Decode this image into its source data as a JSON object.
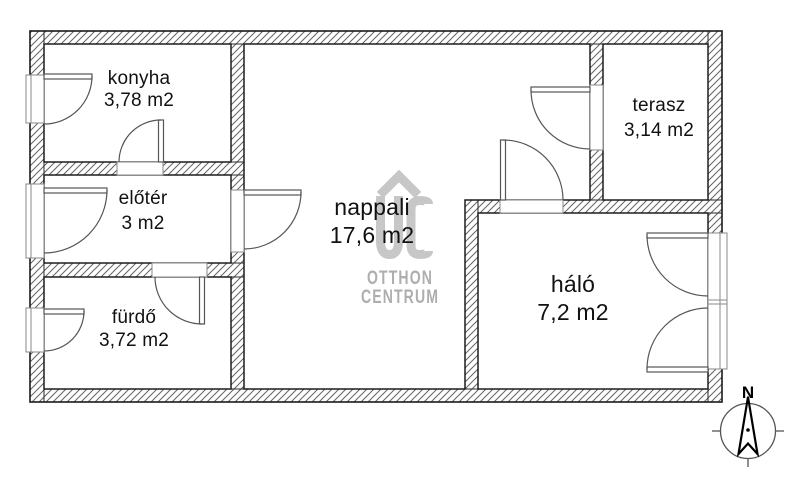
{
  "rooms": [
    {
      "name": "konyha",
      "area": "3,78 m2"
    },
    {
      "name": "előtér",
      "area": "3 m2"
    },
    {
      "name": "fürdő",
      "area": "3,72 m2"
    },
    {
      "name": "nappali",
      "area": "17,6 m2"
    },
    {
      "name": "háló",
      "area": "7,2 m2"
    },
    {
      "name": "terasz",
      "area": "3,14 m2"
    }
  ],
  "watermark": {
    "monogram": "OC",
    "line1": "OTTHON",
    "line2": "CENTRUM"
  },
  "compass": {
    "north": "N"
  },
  "colors": {
    "wall_outline": "#1d1d1d",
    "hatch_line": "#636363",
    "door_line": "#555555",
    "watermark_logo": "#c7c7c7",
    "watermark_text": "#aeaeae",
    "label_text": "#111111"
  }
}
